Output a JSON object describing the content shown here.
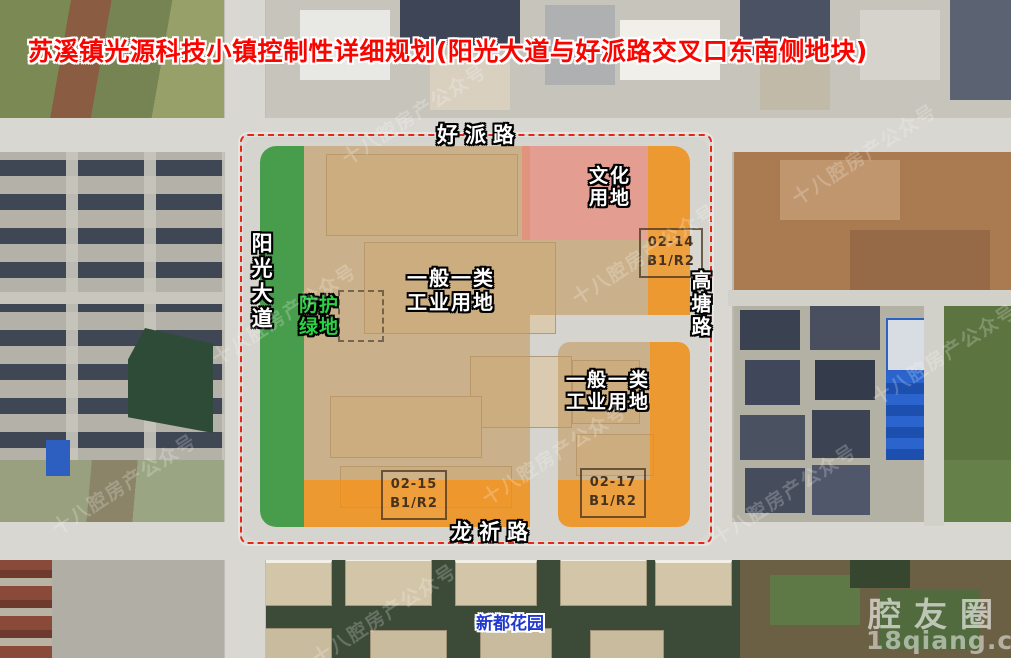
{
  "title": "苏溪镇光源科技小镇控制性详细规划(阳光大道与好派路交叉口东南侧地块)",
  "roads": {
    "north": "好派路",
    "west": "阳光大道",
    "east": "高塘路",
    "south": "龙祈路"
  },
  "zones": {
    "industrial_main": {
      "line1": "一般一类",
      "line2": "工业用地"
    },
    "industrial_se": {
      "line1": "一般一类",
      "line2": "工业用地"
    },
    "culture": {
      "line1": "文化",
      "line2": "用地"
    },
    "green_buffer": {
      "line1": "防护",
      "line2": "绿地"
    }
  },
  "parcels": [
    {
      "code": "02-14",
      "use": "B1/R2"
    },
    {
      "code": "02-15",
      "use": "B1/R2"
    },
    {
      "code": "02-17",
      "use": "B1/R2"
    }
  ],
  "places": {
    "residential": "新都花园"
  },
  "watermark": {
    "tiled": "十八腔房产公众号",
    "brand": "腔友圈",
    "site": "18qiang.com"
  },
  "colors": {
    "industrial_strip_fill": "#F08E16",
    "green_buffer_fill": "#2F9E3C",
    "culture_fill": "#EB8778",
    "industrial_land_fill": "#C3985C",
    "boundary_dash": "#E52718",
    "title_text": "#FA0400",
    "place_label_text": "#2038D0"
  }
}
